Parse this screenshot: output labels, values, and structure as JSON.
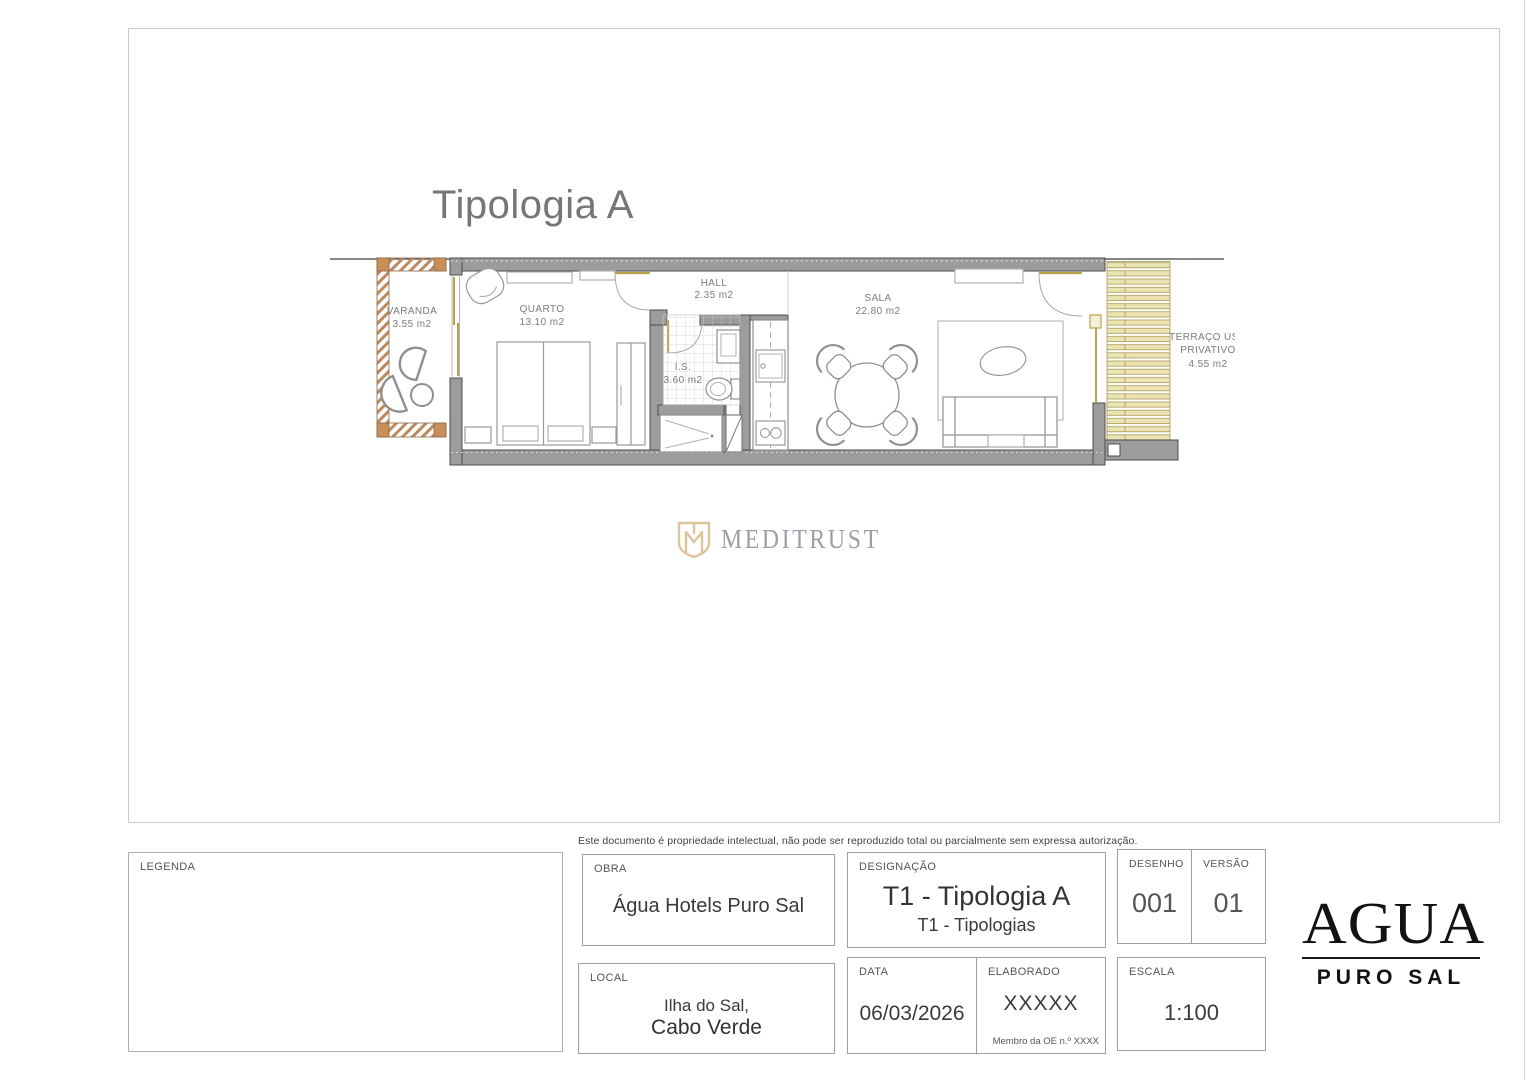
{
  "sheet": {
    "drawing_title": "Tipologia A",
    "disclaimer": "Este documento é propriedade intelectual, não pode ser reproduzido total ou parcialmente sem expressa autorização."
  },
  "plan": {
    "rooms": [
      {
        "name": "VARANDA",
        "area": "3.55 m2"
      },
      {
        "name": "QUARTO",
        "area": "13.10 m2"
      },
      {
        "name": "HALL",
        "area": "2.35 m2"
      },
      {
        "name": "I.S.",
        "area": "3.60 m2"
      },
      {
        "name": "SALA",
        "area": "22.80 m2"
      },
      {
        "name": "TERRAÇO USO",
        "name2": "PRIVATIVO",
        "area": "4.55 m2"
      }
    ]
  },
  "watermark": {
    "text": "MEDITRUST"
  },
  "titleblock": {
    "legenda_label": "LEGENDA",
    "obra_label": "OBRA",
    "obra_value": "Água Hotels Puro Sal",
    "designacao_label": "DESIGNAÇÃO",
    "designacao_value": "T1 - Tipologia A",
    "designacao_sub": "T1 - Tipologias",
    "desenho_label": "DESENHO",
    "desenho_value": "001",
    "versao_label": "VERSÃO",
    "versao_value": "01",
    "local_label": "LOCAL",
    "local_value_line1": "Ilha do Sal,",
    "local_value_line2": "Cabo Verde",
    "data_label": "DATA",
    "data_value": "06/03/2026",
    "elaborado_label": "ELABORADO",
    "elaborado_value": "XXXXX",
    "elaborado_note": "Membro da OE n.º XXXX",
    "escala_label": "ESCALA",
    "escala_value": "1:100"
  },
  "brand": {
    "name": "AGUA",
    "subtitle": "PURO SAL"
  },
  "colors": {
    "wall": "#9c9c9c",
    "wall_edge": "#4d4d4d",
    "wood_accent": "#c08f58",
    "deck_band": "#ece3b2",
    "deck_line": "#a79a54",
    "frame_khaki": "#b8a24a",
    "watermark_gold": "#dcc49c",
    "watermark_text": "#9ba0a8",
    "title_gray": "#767676"
  }
}
